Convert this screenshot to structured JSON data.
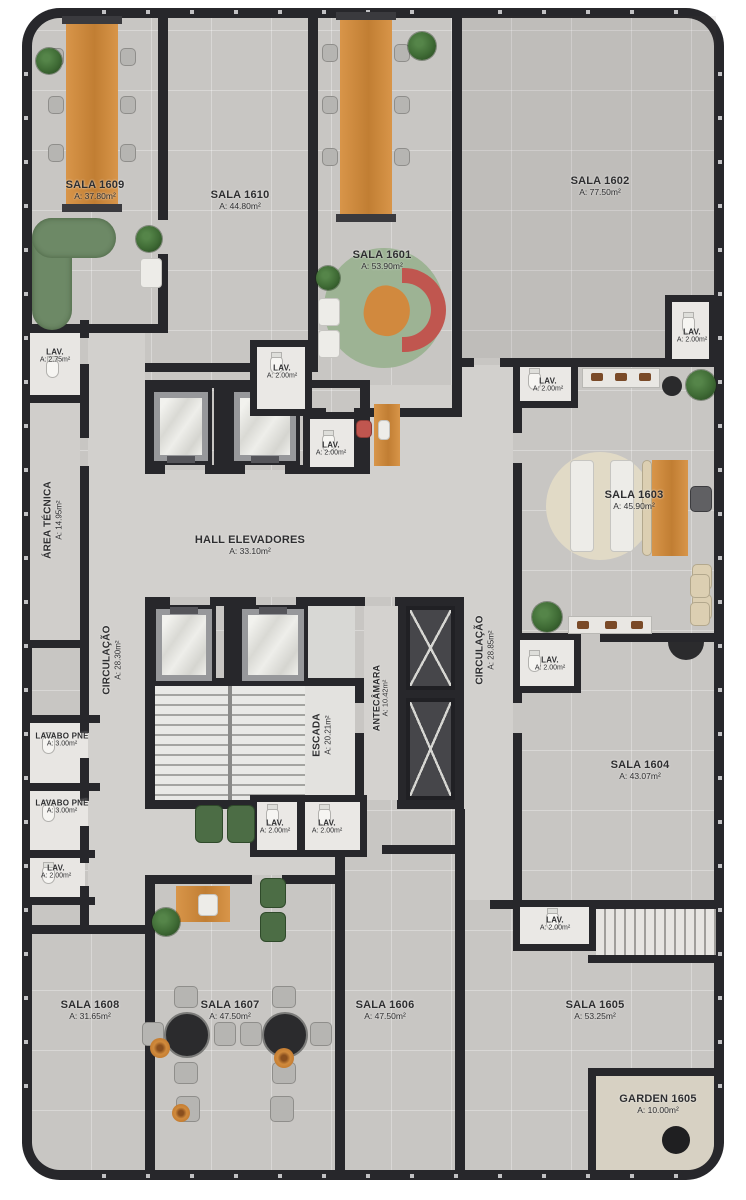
{
  "rooms": [
    {
      "name": "SALA 1609",
      "area": "A: 37.80m²"
    },
    {
      "name": "SALA 1610",
      "area": "A: 44.80m²"
    },
    {
      "name": "SALA 1601",
      "area": "A: 53.90m²"
    },
    {
      "name": "SALA 1602",
      "area": "A: 77.50m²"
    },
    {
      "name": "SALA 1603",
      "area": "A: 45.90m²"
    },
    {
      "name": "SALA 1604",
      "area": "A: 43.07m²"
    },
    {
      "name": "SALA 1605",
      "area": "A: 53.25m²"
    },
    {
      "name": "SALA 1606",
      "area": "A: 47.50m²"
    },
    {
      "name": "SALA 1607",
      "area": "A: 47.50m²"
    },
    {
      "name": "SALA 1608",
      "area": "A: 31.65m²"
    },
    {
      "name": "GARDEN 1605",
      "area": "A: 10.00m²"
    }
  ],
  "services": [
    {
      "name": "HALL ELEVADORES",
      "area": "A: 33.10m²"
    },
    {
      "name": "ÁREA TÉCNICA",
      "area": "A: 14.95m²"
    },
    {
      "name": "CIRCULAÇÃO",
      "area": "A: 28.30m²"
    },
    {
      "name": "CIRCULAÇÃO",
      "area": "A: 28.85m²"
    },
    {
      "name": "ESCADA",
      "area": "A: 20.21m²"
    },
    {
      "name": "ANTECÂMARA",
      "area": "A: 10.42m²"
    },
    {
      "name": "LAVABO PNE",
      "area": "A: 3.00m²"
    },
    {
      "name": "LAVABO PNE",
      "area": "A: 3.00m²"
    }
  ],
  "lavs": [
    {
      "name": "LAV.",
      "area": "A: 2.75m²"
    },
    {
      "name": "LAV.",
      "area": "A: 2.00m²"
    },
    {
      "name": "LAV.",
      "area": "A: 2.00m²"
    },
    {
      "name": "LAV.",
      "area": "A: 2.00m²"
    },
    {
      "name": "LAV.",
      "area": "A: 2.00m²"
    },
    {
      "name": "LAV.",
      "area": "A: 2.00m²"
    },
    {
      "name": "LAV.",
      "area": "A: 2.00m²"
    },
    {
      "name": "LAV.",
      "area": "A: 2.00m²"
    },
    {
      "name": "LAV.",
      "area": "A: 2.00m²"
    },
    {
      "name": "LAV.",
      "area": "A: 2.00m²"
    }
  ],
  "colors": {
    "wall": "#27272b",
    "floor": "#c8c6c3",
    "corridor_floor": "#d2d0cd",
    "wood_accent": "#d1893e",
    "sofa_red": "#c0564f",
    "sofa_green": "#6d8966",
    "rug_green": "#9db394",
    "rug_beige": "#e1dac6",
    "plant_green": "#3f6b35",
    "garden_floor": "#d7d1c3"
  }
}
